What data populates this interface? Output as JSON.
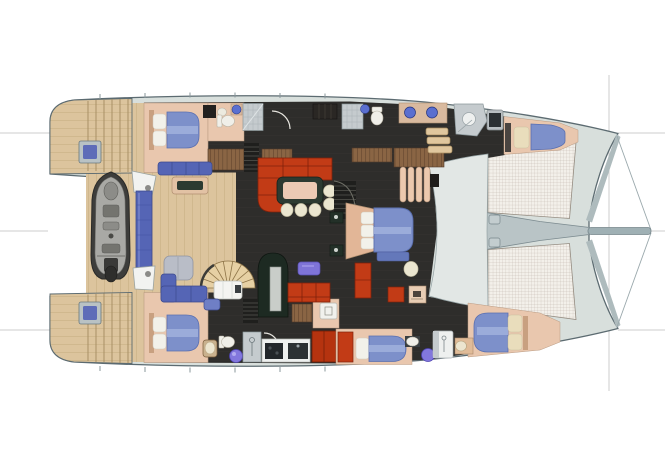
{
  "canvas": {
    "width": 665,
    "height": 470,
    "background": "#ffffff"
  },
  "plan": {
    "type": "catamaran-yacht-deck-plan",
    "view": "top-down",
    "orientation": "bow-right",
    "areas": [
      "aft-deck",
      "port-transom",
      "starboard-transom",
      "tender",
      "davit-crane",
      "spiral-staircase",
      "sun-pad",
      "deck-sofa",
      "deck-table",
      "deck-bench",
      "salon",
      "dinette-table",
      "companionway-stairs",
      "master-cabin",
      "port-aft-cabin",
      "port-aft-bathroom",
      "port-forward-bathroom",
      "shower",
      "crew-cabin",
      "starboard-aft-cabin",
      "starboard-aft-bathroom",
      "galley",
      "starboard-mid-cabin",
      "starboard-forward-bathroom",
      "starboard-forward-cabin",
      "fore-cockpit",
      "trampoline-net-port",
      "trampoline-net-starboard",
      "bowsprit"
    ]
  },
  "colors": {
    "hull": "#d8dfdc",
    "hullStroke": "#5c6b71",
    "interiorFloor": "#2e2d2b",
    "cabinFloor": "#e9c7ae",
    "bedBlue": "#7d90ca",
    "bedBlueDark": "#5a6fb0",
    "bedRunner": "#9fafdb",
    "pillowWhite": "#f2f1ea",
    "pillowCream": "#e9ddbc",
    "headboardPeach": "#c8a080",
    "sofaRed": "#c23b16",
    "sofaRedDark": "#80220b",
    "tableGreen": "#2c3a31",
    "tableTopPeach": "#eccab4",
    "cream": "#ebe6d0",
    "rugPurple": "#7f74d8",
    "sinkBlue": "#5a6fd0",
    "sinkPurple": "#8277dd",
    "toiletWhite": "#f0efe9",
    "showerGray": "#c5cbce",
    "tenderDark": "#3d3d3b",
    "tenderGray": "#a9a9a5",
    "craneBlue": "#5565b5",
    "craneWhite": "#f2f3f1",
    "sunpadGray": "#b9bdc7",
    "stairDark": "#1f1f1d",
    "archGreen": "#1d2a22",
    "archPanel": "#c9cdc9",
    "fridgeRed": "#b5330f",
    "applianceDark": "#282d31",
    "counterWhite": "#eef0ef",
    "spineGray": "#b9c4c6",
    "bandGray": "#aebbbd",
    "whiteHatch": "#f4f4f1",
    "refLine": "#cccccc",
    "doorArc": "#e8e6e0"
  }
}
